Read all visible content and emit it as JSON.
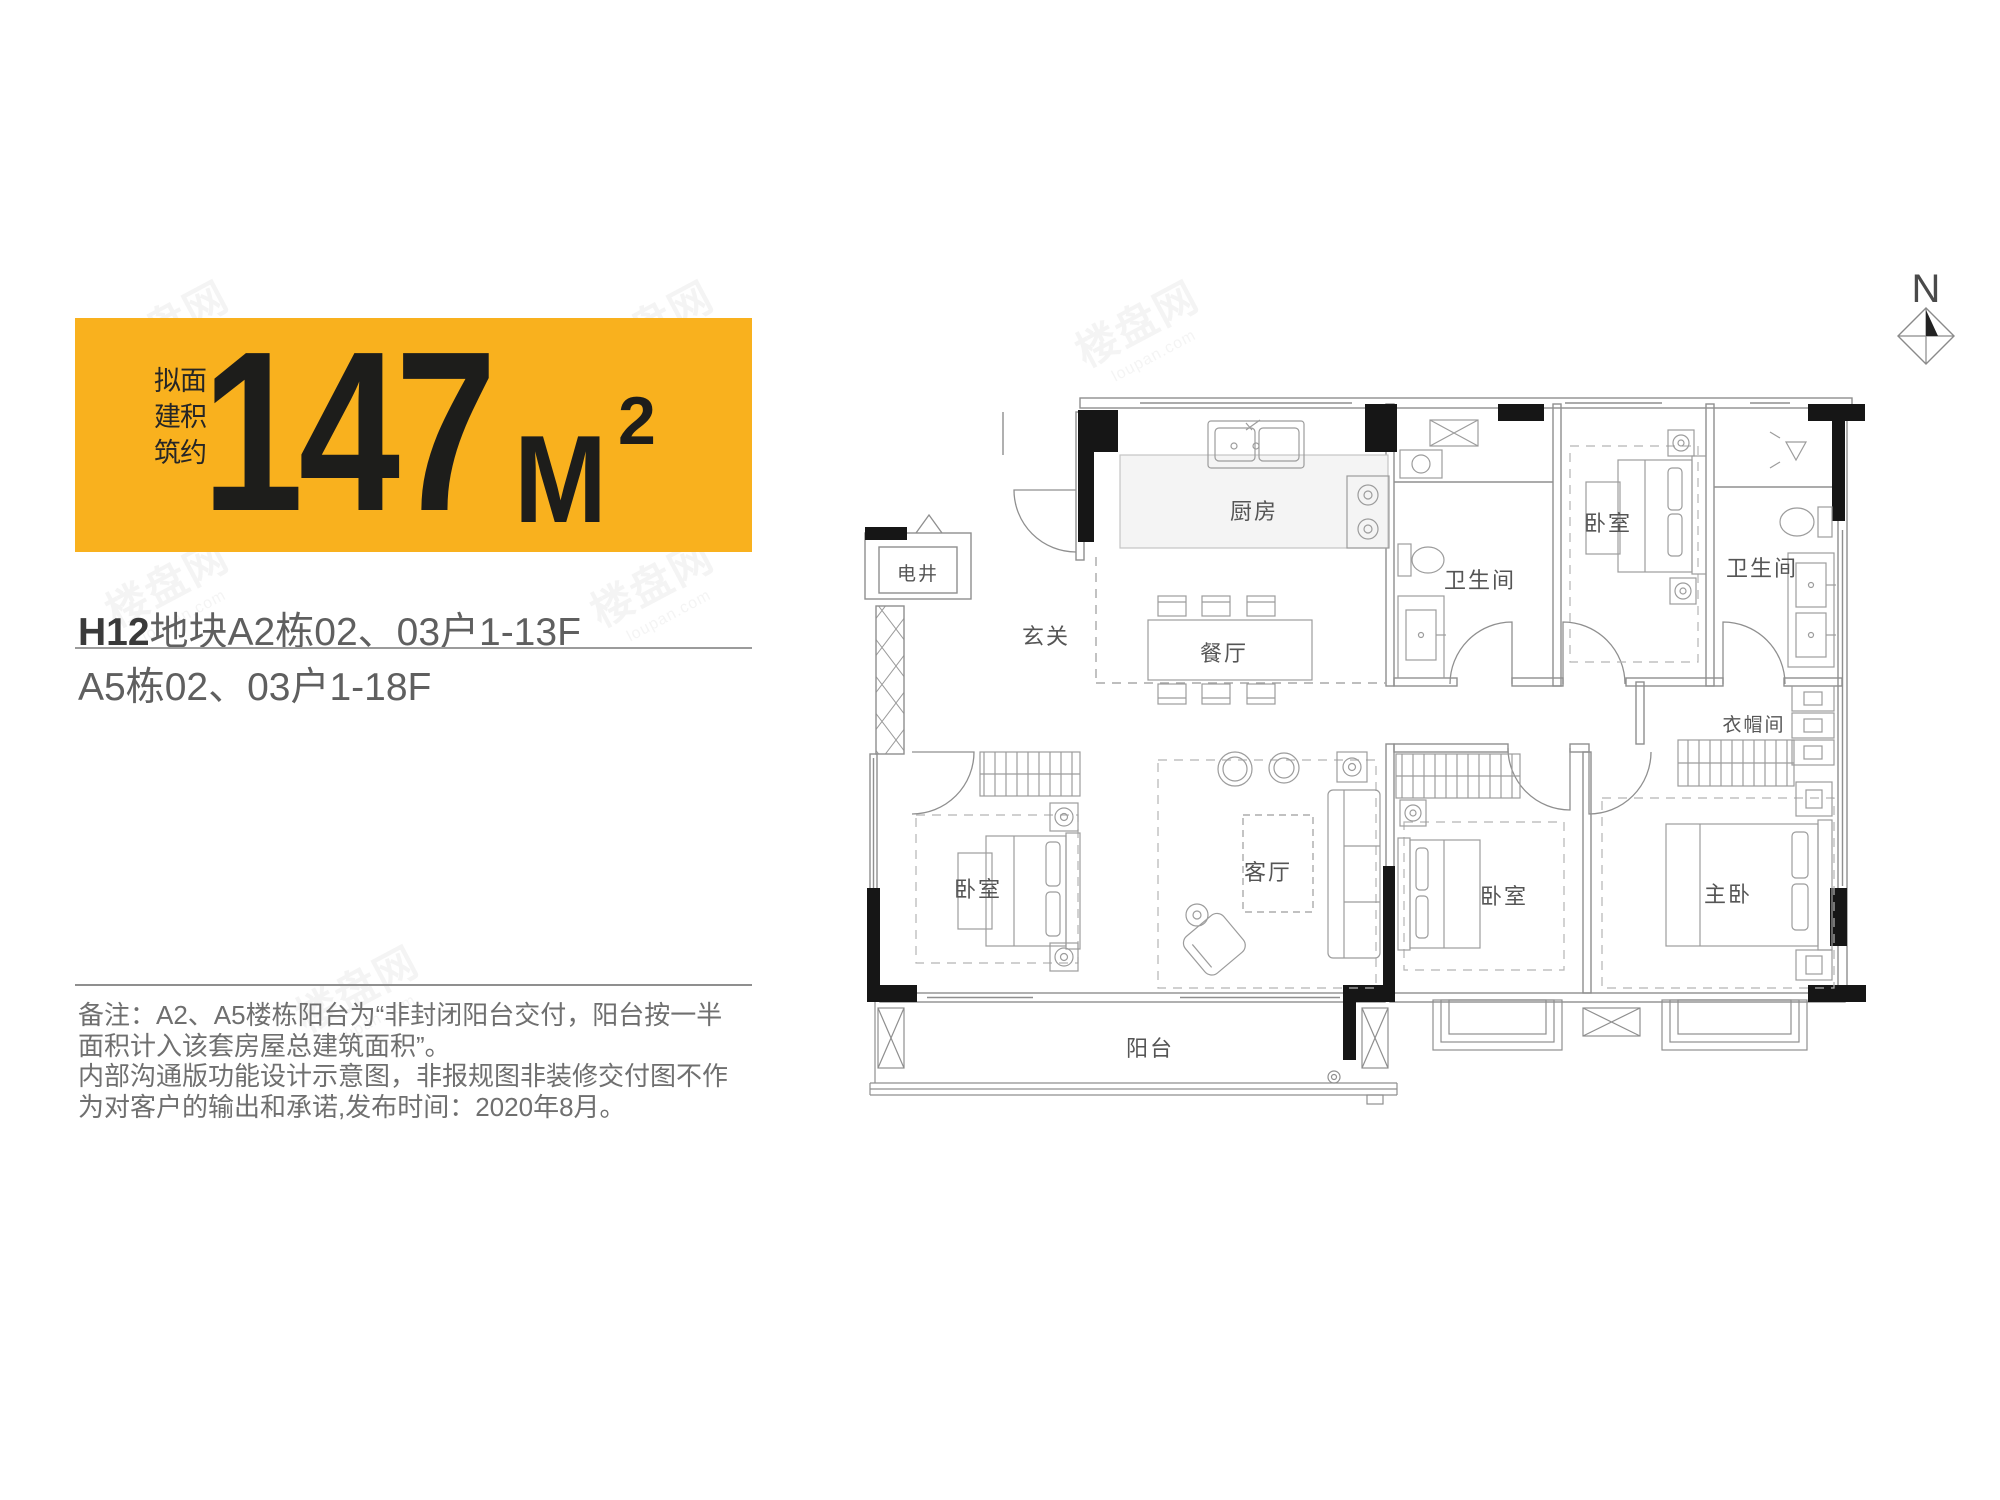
{
  "banner": {
    "vertical_label": "拟建筑面积约",
    "area_value": "147",
    "area_unit": "M",
    "area_exponent": "2",
    "bg_color": "#F9B11E",
    "fg_color": "#1D1D1B"
  },
  "title": {
    "line1_bold": "H12",
    "line1_rest": "地块A2栋02、03户1-13F",
    "line2": "A5栋02、03户1-18F"
  },
  "note": {
    "lines": [
      "备注：A2、A5楼栋阳台为“非封闭阳台交付，阳台按一半",
      "面积计入该套房屋总建筑面积”。",
      "内部沟通版功能设计示意图，非报规图非装修交付图不作",
      "为对客户的输出和承诺,发布时间：2020年8月。"
    ]
  },
  "compass": {
    "label": "N"
  },
  "rooms": {
    "dianjing": "电井",
    "xuanguan": "玄关",
    "chufang": "厨房",
    "canting": "餐厅",
    "bath1": "卫生间",
    "bed_top": "卧室",
    "bath2": "卫生间",
    "closet": "衣帽间",
    "bed_left": "卧室",
    "living": "客厅",
    "bed_mid": "卧室",
    "master": "主卧",
    "balcony": "阳台"
  },
  "watermark": {
    "brand": "楼盘网",
    "domain": "loupan.com"
  }
}
